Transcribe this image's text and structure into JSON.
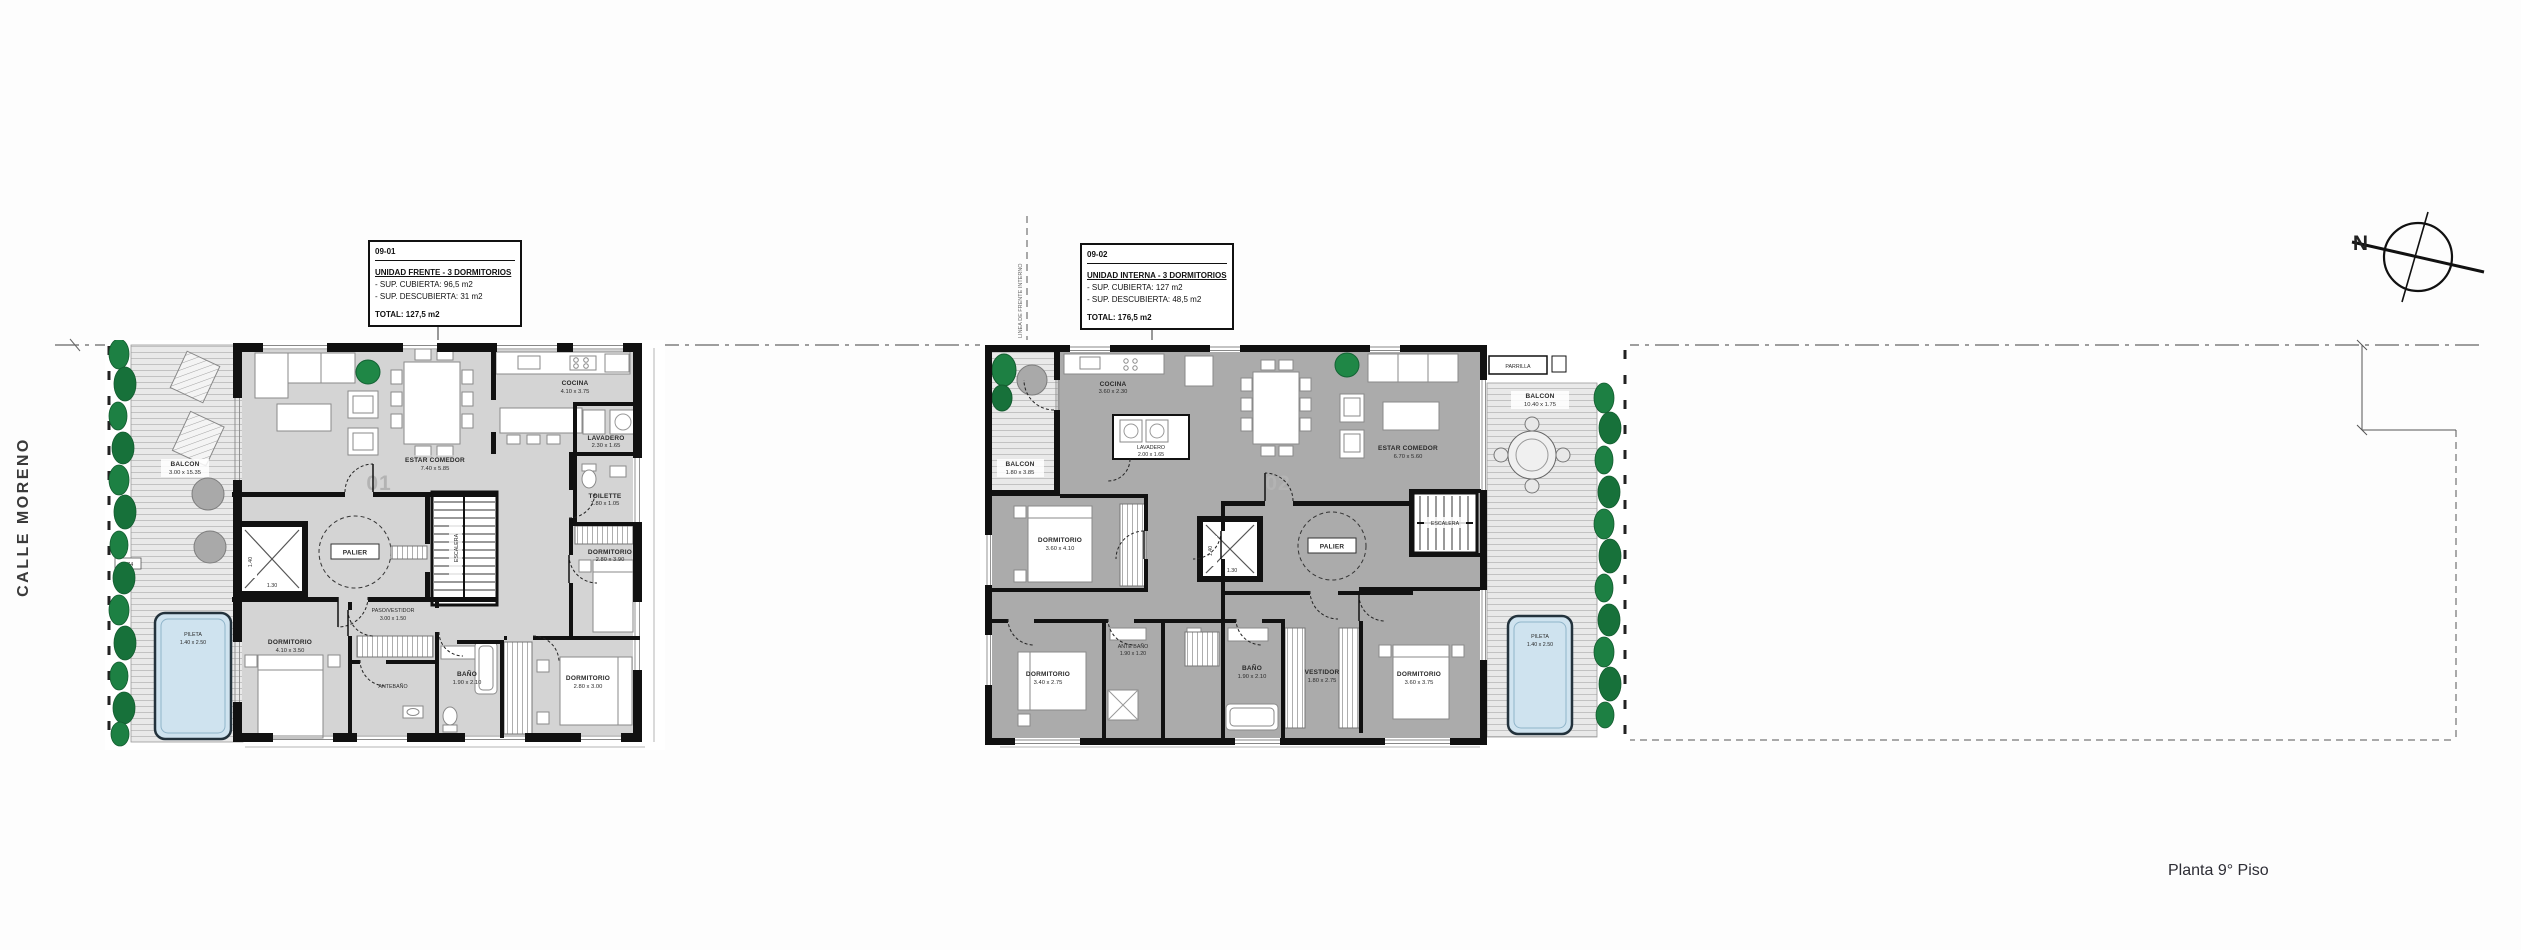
{
  "page": {
    "plan_title": "Planta 9° Piso"
  },
  "street": {
    "name": "CALLE MORENO"
  },
  "compass": {
    "north": "N"
  },
  "axes": {
    "internal_front_line": "LINEA DE FRENTE INTERNO"
  },
  "unit1": {
    "number": "01",
    "info": {
      "code": "09-01",
      "title": "UNIDAD FRENTE - 3 DORMITORIOS",
      "covered": "- SUP. CUBIERTA: 96,5 m2",
      "uncovered": "- SUP. DESCUBIERTA: 31 m2",
      "total": "TOTAL: 127,5 m2"
    },
    "rooms": {
      "balcon": {
        "name": "BALCON",
        "dims": "3.00 x 15.35"
      },
      "pileta": {
        "name": "PILETA",
        "dims": "1.40 x 2.50"
      },
      "estar_comedor": {
        "name": "ESTAR COMEDOR",
        "dims": "7.40 x 5.85"
      },
      "cocina": {
        "name": "COCINA",
        "dims": "4.10 x 3.75"
      },
      "lavadero": {
        "name": "LAVADERO",
        "dims": "2.30 x 1.65"
      },
      "toilette": {
        "name": "TOILETTE",
        "dims": "1.80 x 1.05"
      },
      "dormitorio_1": {
        "name": "DORMITORIO",
        "dims": "2.80 x 3.90"
      },
      "dormitorio_2": {
        "name": "DORMITORIO",
        "dims": "2.80 x 3.00"
      },
      "dormitorio_3": {
        "name": "DORMITORIO",
        "dims": "4.10 x 3.50"
      },
      "paso_vestidor": {
        "name": "PASO/VESTIDOR",
        "dims": "3.00 x 1.50"
      },
      "bano": {
        "name": "BAÑO",
        "dims": "1.90 x 2.10"
      },
      "antebano": {
        "name": "ANTEBAÑO"
      },
      "palier": {
        "name": "PALIER"
      },
      "escalera": {
        "name": "ESCALERA"
      },
      "ascensor": {
        "width": "1.40",
        "depth": "1.30"
      }
    },
    "annotations": {
      "offset": "0.74"
    }
  },
  "unit2": {
    "number": "02",
    "info": {
      "code": "09-02",
      "title": "UNIDAD INTERNA - 3 DORMITORIOS",
      "covered": "- SUP. CUBIERTA: 127 m2",
      "uncovered": "- SUP. DESCUBIERTA: 48,5 m2",
      "total": "TOTAL: 176,5 m2"
    },
    "rooms": {
      "balcon_frente": {
        "name": "BALCON",
        "dims": "1.80 x 3.85"
      },
      "balcon_lateral": {
        "name": "BALCON",
        "dims": "10.40 x 1.75"
      },
      "pileta": {
        "name": "PILETA",
        "dims": "1.40 x 2.50"
      },
      "parrilla": {
        "name": "PARRILLA"
      },
      "estar_comedor": {
        "name": "ESTAR COMEDOR",
        "dims": "6.70 x 5.60"
      },
      "cocina": {
        "name": "COCINA",
        "dims": "3.60 x 2.30"
      },
      "lavadero": {
        "name": "LAVADERO",
        "dims": "2.00 x 1.65"
      },
      "dormitorio_1": {
        "name": "DORMITORIO",
        "dims": "3.60 x 4.10"
      },
      "dormitorio_2": {
        "name": "DORMITORIO",
        "dims": "3.40 x 2.75"
      },
      "dormitorio_3": {
        "name": "DORMITORIO",
        "dims": "3.60 x 3.75"
      },
      "ante_bano": {
        "name": "ANTE BAÑO",
        "dims": "1.90 x 1.20"
      },
      "bano": {
        "name": "BAÑO",
        "dims": "1.90 x 2.10"
      },
      "vestidor": {
        "name": "VESTIDOR",
        "dims": "1.80 x 2.75"
      },
      "palier": {
        "name": "PALIER"
      },
      "escalera": {
        "name": "ESCALERA"
      },
      "ascensor": {
        "width": "1.40",
        "depth": "1.30"
      }
    }
  },
  "colors": {
    "deck": "#e9e9e9",
    "interior_light": "#d4d4d4",
    "interior_dark": "#ababab",
    "hedge_green": "#1d8043",
    "pool_blue": "#cfe3ef",
    "wall": "#111111"
  }
}
